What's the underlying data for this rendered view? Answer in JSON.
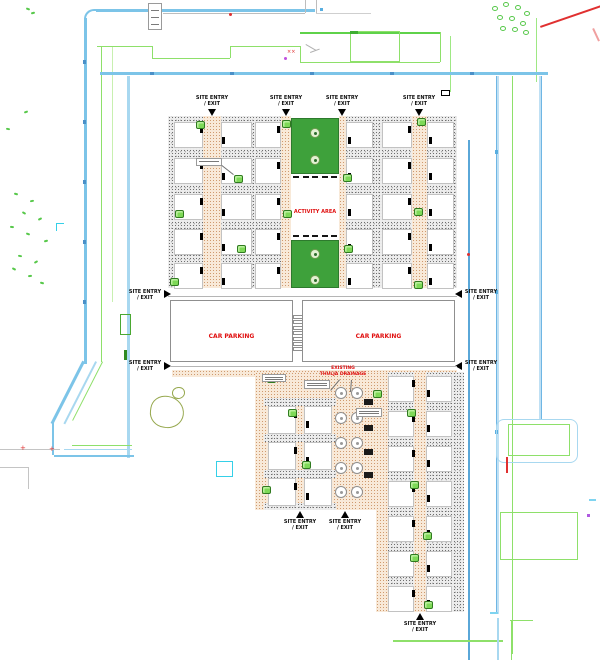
{
  "labels": {
    "site_entry_line1": "SITE ENTRY",
    "site_entry_line2": "/ EXIT",
    "activity_area": "ACTIVITY AREA",
    "car_parking_left": "CAR PARKING",
    "car_parking_right": "CAR PARKING",
    "drainage_line1": "EXISTING",
    "drainage_line2": "THULJA DRAINAGE"
  },
  "blocks": {
    "upper": {
      "columns": [
        [
          50,
          48,
          46,
          44,
          42
        ],
        [
          49,
          47,
          45,
          43,
          41
        ],
        [
          26,
          28,
          30,
          32,
          34
        ],
        [
          25,
          27,
          29,
          31,
          33
        ],
        [
          24,
          22,
          20,
          18,
          16
        ],
        [
          23,
          21,
          19,
          17,
          15
        ]
      ]
    },
    "lower_left": {
      "columns": [
        [
          36,
          38,
          40
        ],
        [
          35,
          37,
          39
        ]
      ]
    },
    "lower_right": {
      "columns": [
        [
          14,
          12,
          10,
          8,
          6,
          4,
          2
        ],
        [
          13,
          11,
          9,
          7,
          5,
          3,
          1
        ]
      ]
    }
  },
  "site_entries": {
    "top": 4,
    "left": 2,
    "right": 2,
    "bottom": 3
  },
  "colors": {
    "plot_number_red": "#e81010",
    "label_red": "#e01010",
    "activity_green": "#3ea13b",
    "boundary_blue": "#7cc4e8",
    "inner_road_blue": "#a8d8f0",
    "vegetation_green": "#57c84a",
    "neighbor_outline_green": "#8ee06a",
    "tree_olive": "#96a84e"
  }
}
